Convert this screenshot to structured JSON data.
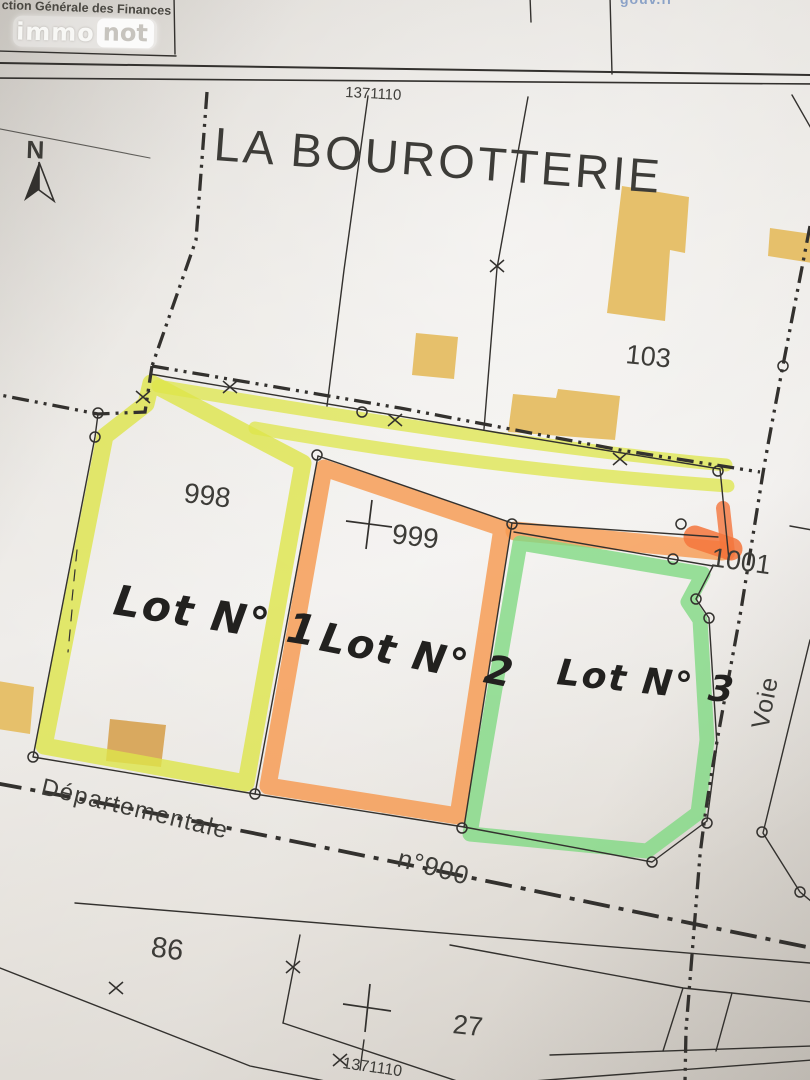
{
  "header": {
    "agency_text": "ction Générale des Finances",
    "watermark_immo": "immo",
    "watermark_not": "not",
    "website_text": "gouv.fr"
  },
  "map": {
    "place_title": "LA BOUROTTERIE",
    "sheet_number_top": "1371110",
    "sheet_number_bottom": "1371110",
    "north_label": "N",
    "parcels": [
      {
        "id": "998"
      },
      {
        "id": "999"
      },
      {
        "id": "1001"
      },
      {
        "id": "103"
      },
      {
        "id": "86"
      },
      {
        "id": "27"
      }
    ],
    "lots": [
      {
        "label": "Lot N° 1",
        "color": "#dde54a"
      },
      {
        "label": "Lot N° 2",
        "color": "#f79a50"
      },
      {
        "label": "Lot N° 3",
        "color": "#81d983"
      }
    ],
    "roads": [
      {
        "name": "Départementale"
      },
      {
        "name": "n°900"
      },
      {
        "name": "Voie"
      }
    ]
  },
  "colors": {
    "line": "#33312e",
    "building_fill": "#e6c06b",
    "building_fill_dark": "#d9a95f",
    "lot1_highlight": "#dde54a",
    "lot2_highlight": "#f79a50",
    "lot2_highlight_hot": "#f4763c",
    "lot3_highlight": "#81d983"
  }
}
